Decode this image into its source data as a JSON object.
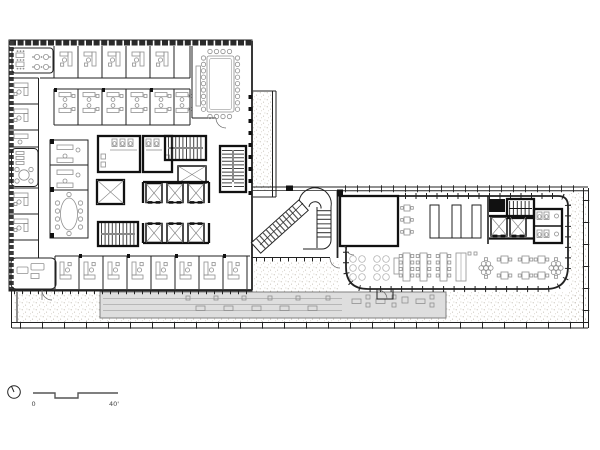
{
  "drawing": {
    "kind": "office-floor-plan",
    "background": "#ffffff"
  },
  "colors": {
    "line": "#222222",
    "wall_dark": "#111111",
    "furniture": "#909090",
    "stipple_dot_a": "#b3ab9e",
    "stipple_dot_b": "#c6bfb3",
    "covered_terrace_fill": "#dedede",
    "covered_terrace_edge": "#808080",
    "plank_line": "#bbbbbb"
  },
  "scale_bar": {
    "start_label": "0",
    "end_label": "40'"
  },
  "north_arrow": {
    "icon": "north-arrow-icon"
  }
}
